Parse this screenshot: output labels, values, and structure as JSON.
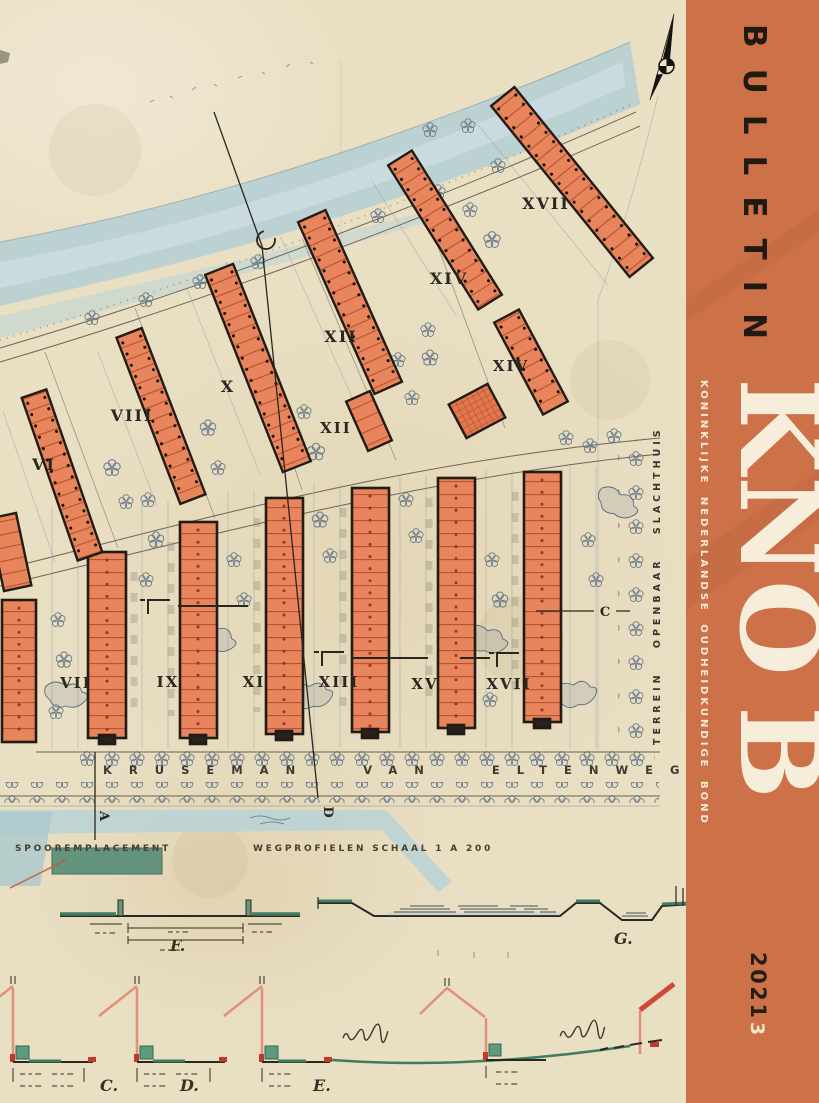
{
  "spine": {
    "title_vertical": "BULLETIN",
    "acronym_letters": [
      "K",
      "N",
      "O",
      "B"
    ],
    "organization": "KONINKLIJKE NEDERLANDSE OUDHEIDKUNDIGE BOND",
    "year": "2021",
    "issue": "3",
    "band_color": "#cd7148",
    "title_color": "#201a12",
    "acronym_color": "#f6eedb"
  },
  "plan": {
    "street_name": "KRUSEMAN VAN ELTENWEG",
    "terrain_label": "TERREIN OPENBAAR SLACHTHUIS",
    "railway_label": "SPOOREMPLACEMENT",
    "profiles_title": "WEGPROFIELEN SCHAAL 1 A 200",
    "upper_block_labels": [
      "VI",
      "VIII",
      "X",
      "XII",
      "XII",
      "XIV",
      "XIV",
      "XVII"
    ],
    "lower_block_labels": [
      "VII",
      "IX",
      "XI",
      "XIII",
      "XV",
      "XVII"
    ],
    "section_marks": [
      "A",
      "D",
      "C"
    ],
    "profile_marks": [
      "C.",
      "D.",
      "E.",
      "F.",
      "G."
    ],
    "north_icon": "compass-north-arrow"
  },
  "colors": {
    "paper": "#e9dfc3",
    "building_orange": "#e9855c",
    "canal_blue": "#b7cfd4",
    "profile_green": "#3e7d5f",
    "accent_red": "#c0392b",
    "ink": "#2a251e"
  }
}
